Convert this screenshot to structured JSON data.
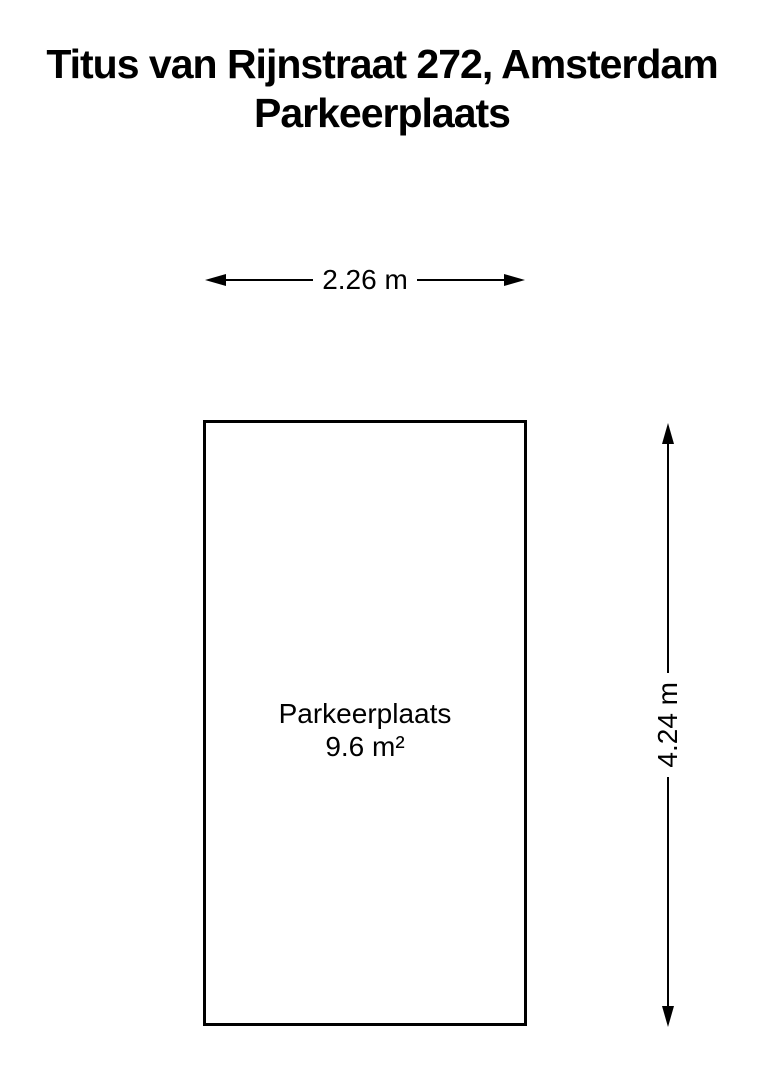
{
  "title": {
    "line1": "Titus van Rijnstraat 272, Amsterdam",
    "line2": "Parkeerplaats"
  },
  "dimensions": {
    "width_label": "2.26 m",
    "height_label": "4.24 m"
  },
  "room": {
    "name": "Parkeerplaats",
    "area": "9.6 m²"
  },
  "colors": {
    "background": "#ffffff",
    "line": "#000000",
    "text": "#000000"
  }
}
